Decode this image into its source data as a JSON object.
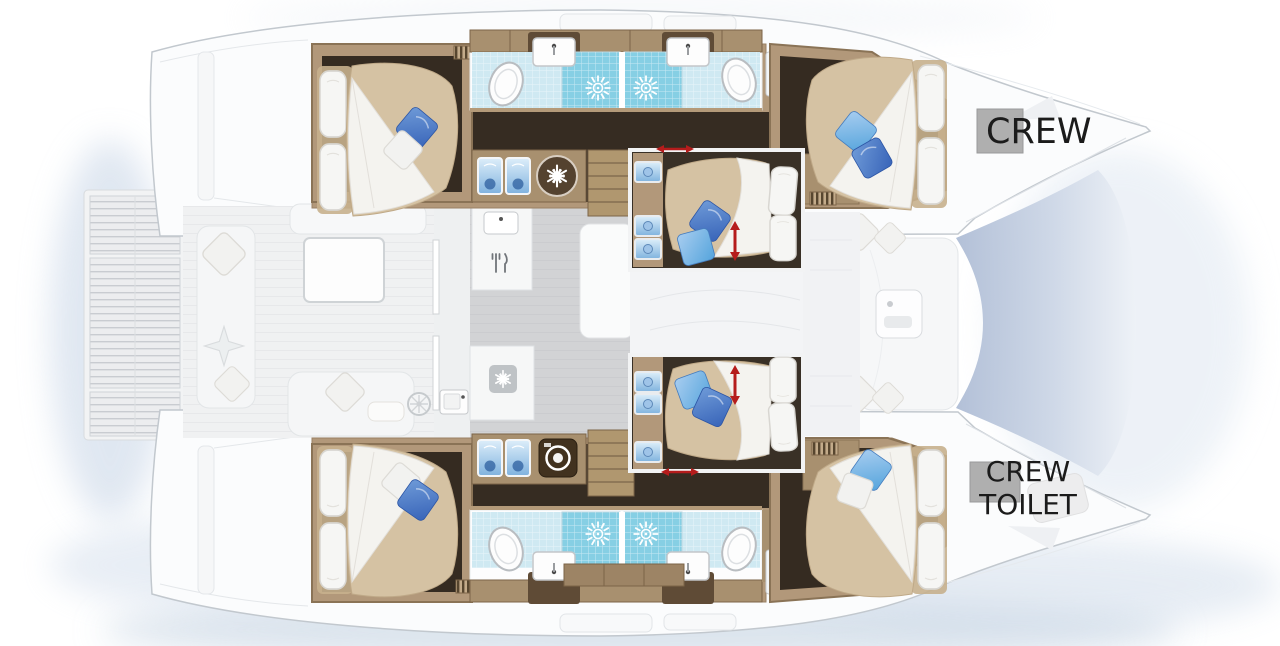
{
  "labels": {
    "crew": "CREW",
    "crew_toilet_line1": "CREW",
    "crew_toilet_line2": "TOILET"
  },
  "colors": {
    "hull_white": "#fbfcfd",
    "outline_gray": "#c2c8ce",
    "wood": "#b2987a",
    "wood_dark": "#7c6448",
    "floor_dark": "#352b21",
    "mattress_tan": "#d5c2a3",
    "duvet_white": "#f4f3ef",
    "tile_blue": "#cfe9f2",
    "shower_blue": "#86cfe4",
    "pillow_blue": "#4a77c4",
    "pillow_light_blue": "#7fb0e0",
    "salon_gray": "#d2d3d5",
    "deck_light": "#f0f1f2",
    "accent_red": "#b51c1c",
    "label_text": "#1b1b1b",
    "water_shadow": "#c6d4e6",
    "hatch_gray": "#a2a2a2"
  },
  "icons": [
    "shower-jet-icon",
    "toilet-icon",
    "sink-icon",
    "basin-icon",
    "snowflake-icon",
    "washer-icon",
    "fan-icon",
    "cutlery-icon",
    "wardrobe-icon",
    "louver-vent-icon",
    "adjust-arrow-icon"
  ]
}
